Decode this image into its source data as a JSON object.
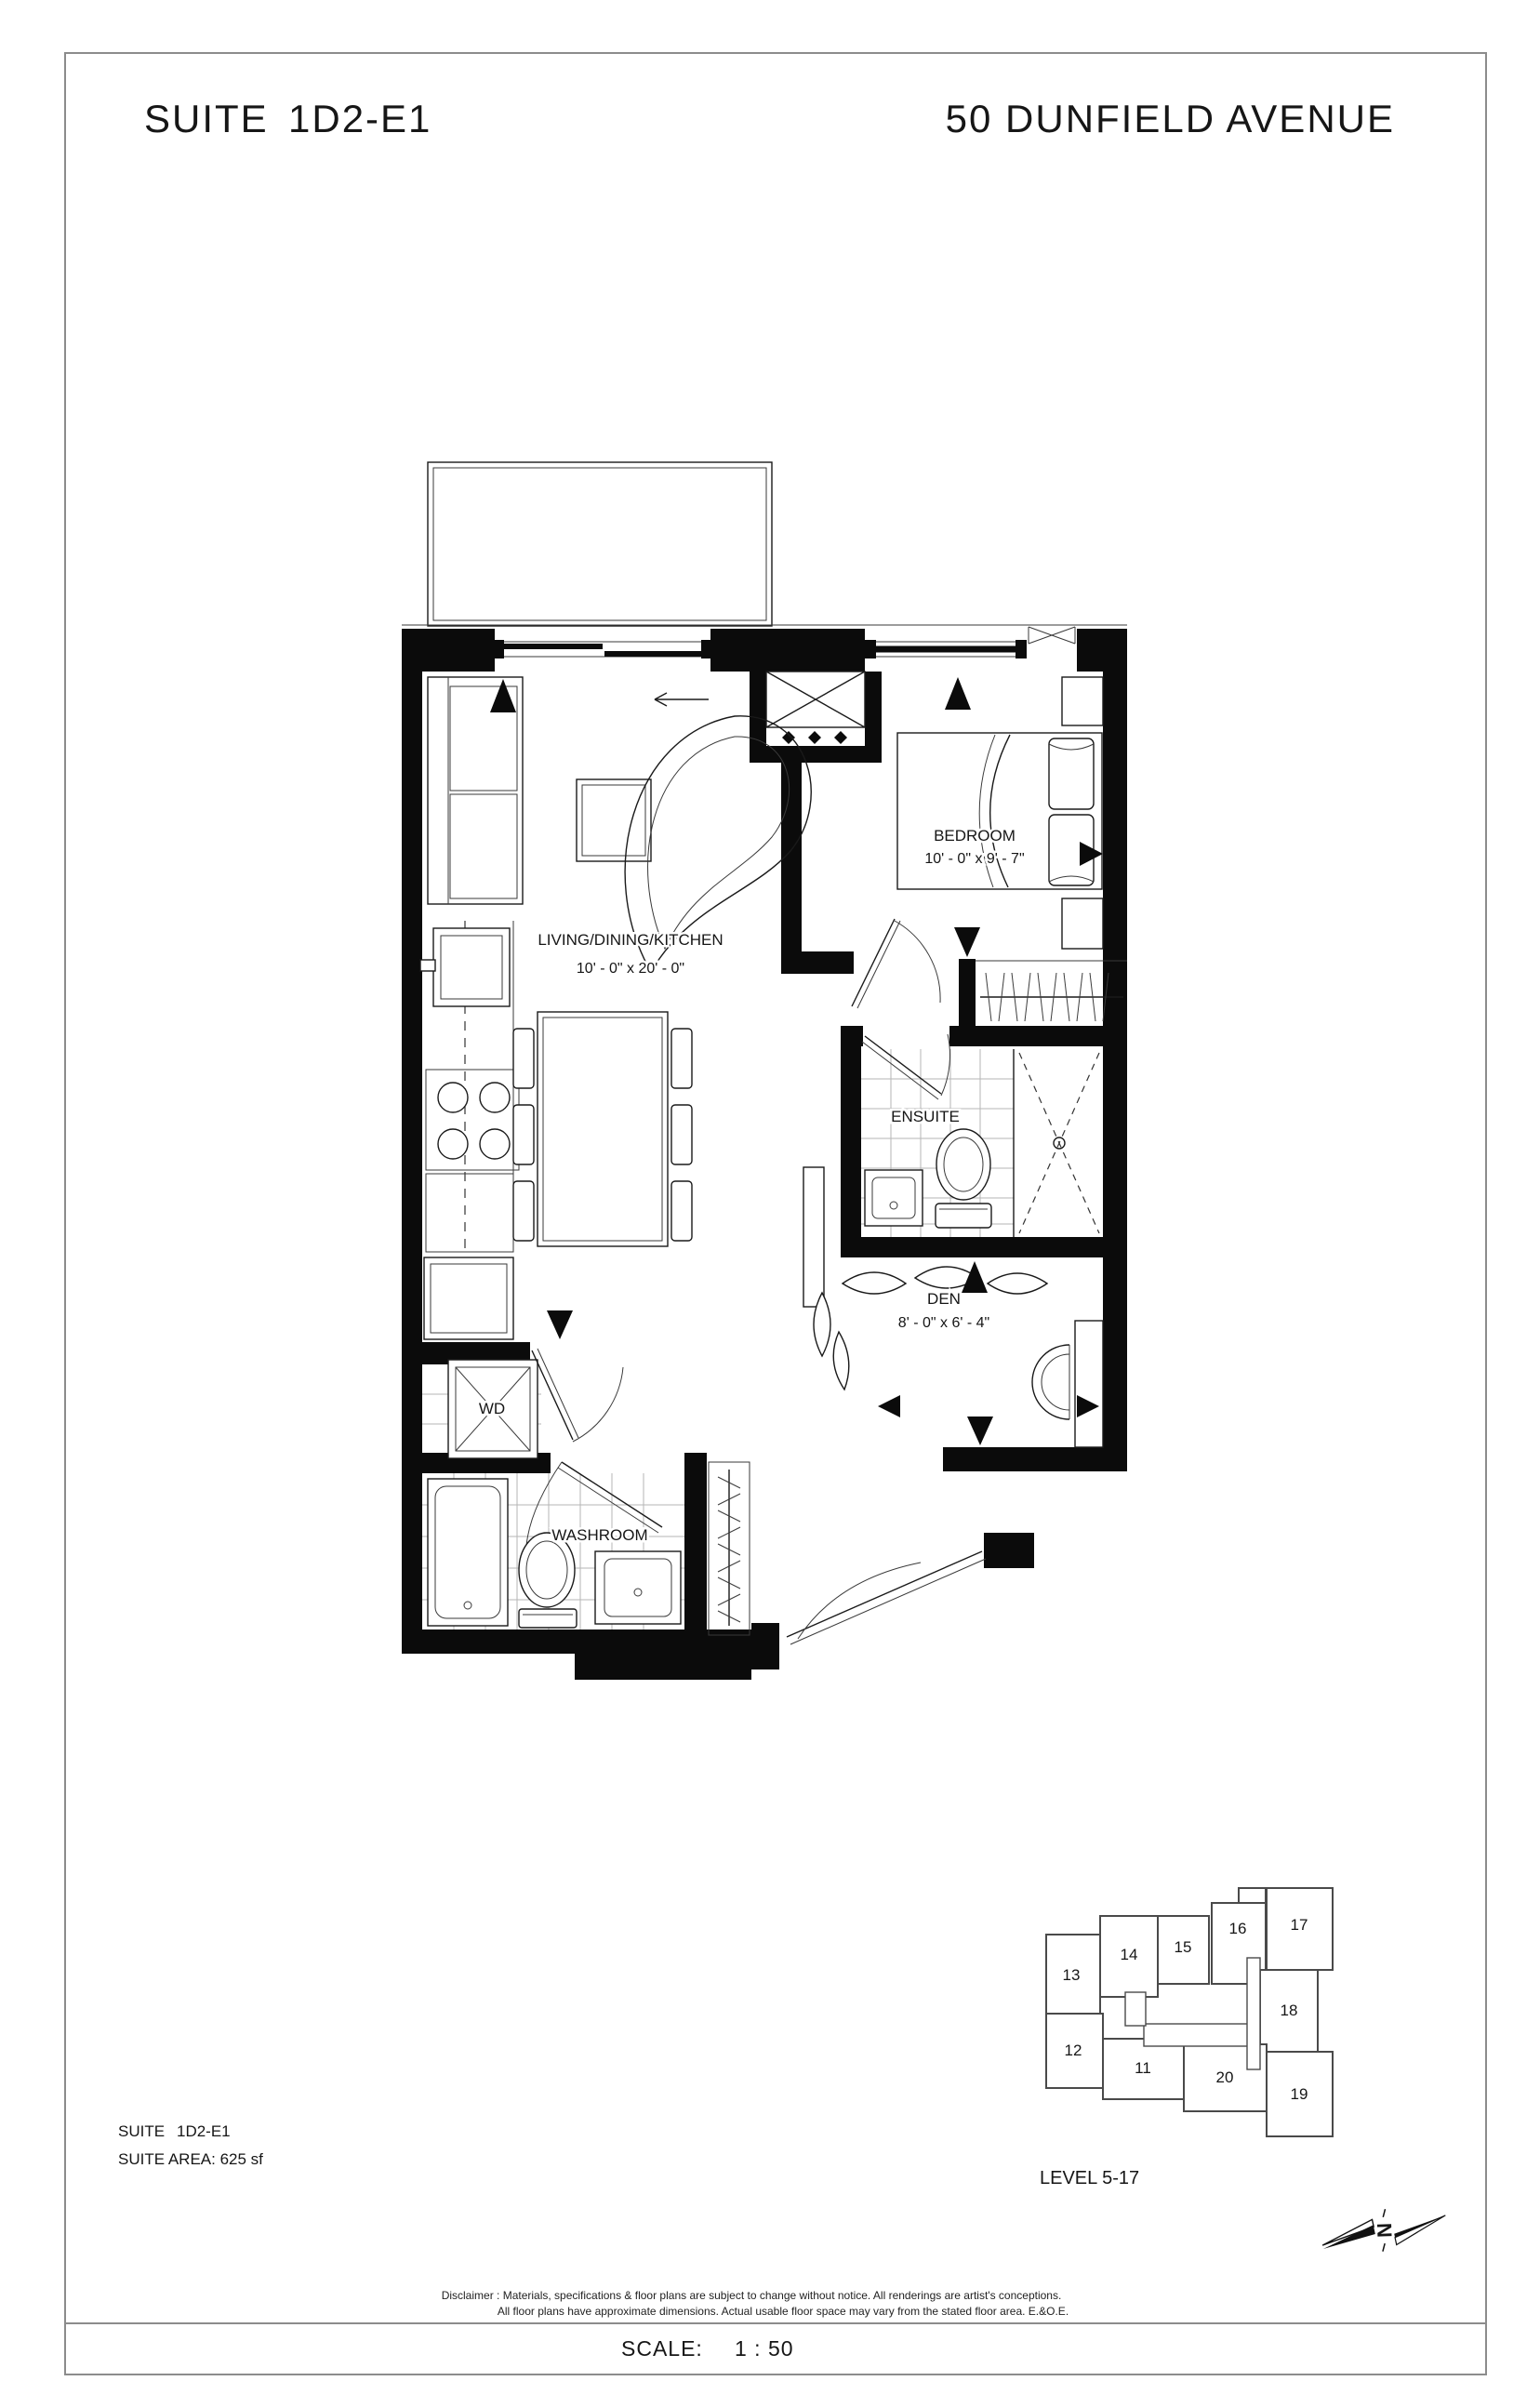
{
  "header": {
    "suite_word": "SUITE",
    "suite_code": "1D2-E1",
    "address": "50 DUNFIELD AVENUE"
  },
  "plan": {
    "living": {
      "name": "LIVING/DINING/KITCHEN",
      "dims": "10' - 0\" x 20' - 0\""
    },
    "bedroom": {
      "name": "BEDROOM",
      "dims": "10' - 0\" x 9' - 7\""
    },
    "ensuite": {
      "name": "ENSUITE"
    },
    "den": {
      "name": "DEN",
      "dims": "8' - 0\" x 6' - 4\""
    },
    "washroom": {
      "name": "WASHROOM"
    },
    "wd": {
      "name": "WD"
    }
  },
  "key_plan": {
    "units": {
      "u11": "11",
      "u12": "12",
      "u13": "13",
      "u14": "14",
      "u15": "15",
      "u16": "16",
      "u17": "17",
      "u18": "18",
      "u19": "19",
      "u20": "20"
    },
    "highlighted_unit": "14",
    "highlight_color": "#b3b3b3",
    "level_label": "LEVEL 5-17"
  },
  "info": {
    "suite_word": "SUITE",
    "suite_code": "1D2-E1",
    "area": "SUITE AREA: 625 sf"
  },
  "footer": {
    "disclaimer_line1": "Disclaimer : Materials, specifications & floor plans are subject to change without notice. All renderings are artist's conceptions.",
    "disclaimer_line2": "All floor plans have approximate dimensions. Actual usable floor space may vary from the stated floor area. E.&O.E.",
    "scale_word": "SCALE:",
    "scale_value": "1 : 50"
  },
  "compass": {
    "north_letter": "N"
  }
}
